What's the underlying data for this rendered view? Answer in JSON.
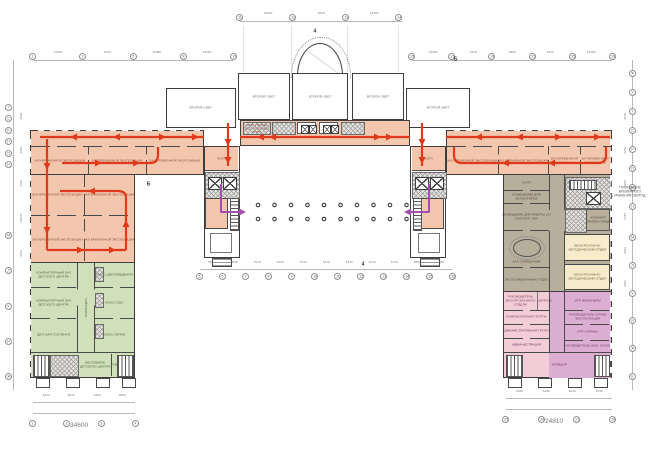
{
  "palette": {
    "exhibition_fill": "#f2c7ae",
    "children_fill": "#cfe0ba",
    "admin_fill": "#b7ae9b",
    "method_fill": "#f6eccb",
    "office_fill": "#f2ccd6",
    "service_fill": "#dcaed2",
    "route_red": "#e03a1a",
    "route_purple": "#a44fb0",
    "wall": "#3e3e3e"
  },
  "rooms": {
    "hall_temp": "ЗАЛ ВРЕМЕННОЙ ЭКСПОЗИЦИИ",
    "second_light": "ВТОРОЙ СВЕТ",
    "hall": "ХОЛЛ",
    "gather": "СБОР У ВХОДА ЭКСКУРСИОННЫХ ГРУПП",
    "computer_class": "КОМПЬЮТЕРНЫЙ ЗАЛ ДЕТСКОГО ЦЕНТРА",
    "kids_lounge": "ДЕТСКАЯ ГОСТИНАЯ",
    "recreation": "РЕКРЕАЦИЯ",
    "class_color": "КЛАСС ЦВЕТОВЕДЕНИЯ",
    "class_izo": "КЛАСС ИЗО",
    "class_lepki": "КЛАСС ЛЕПКИ",
    "kids_vestibule": "ВЕСТИБЮЛЬ ДЕТСКОГО ЦЕНТРА",
    "tambour": "ТАМБУР",
    "volunteers": "ПОМЕЩЕНИЕ ДЛЯ ВОЛОНТЕРОВ",
    "work_attendants": "ПОМЕЩЕНИЕ ДЛЯ РАБОТЫ СО СМОТРИТ. ЗАЛ",
    "meeting": "ЗАЛ СОВЕЩАНИЙ",
    "expo_dept": "ЭКСПОЗИЦИОННЫЙ ОТДЕЛ",
    "eat_room": "КОМНАТА ПРИЕМА ПИЩИ",
    "method_dept": "ЭКСКУРСИОННО-МЕТОДИЧЕСКИЙ ОТДЕЛ",
    "head_excursion": "РУКОВОДИТЕЛЬ ЭКСКУРСИОННОГО ОТДЕЛА",
    "secretary": "СЕКРЕТАРЬ",
    "computer_group": "КОМПЬЮТЕРНАЯ ГРУППА",
    "admin_group": "АДМИНИСТРАТИВНАЯ ГРУППА",
    "administration": "АДМИНИСТРАЦИЯ",
    "itr_eng": "ИТР ИНЖЕНЕРЫ",
    "head_exploitation": "РУКОВОДИТЕЛЬ СЛУЖБ ЭКСПЛУАТАЦИИ",
    "itr_security": "ИТР ОХРАНЫ",
    "head_eng": "РУКОВОДИТЕЛЬ ИНЖ. СЛУЖБ",
    "corridor": "КОРИДОР"
  },
  "annotations": {
    "right_note": "ПОМЕЩЕНИЕ ВРЕМЕННОГО ХРАНЕНИЯ ОБОРУД.",
    "section_top": "4",
    "section_bottom": "4",
    "section_left": "Б",
    "section_right": "Б"
  },
  "grids": {
    "top_center": {
      "bubbles": [
        "11",
        "12",
        "13",
        "14"
      ],
      "dims": [
        "14300",
        "6910",
        "14300"
      ]
    },
    "top_left": {
      "bubbles": [
        "1",
        "3",
        "5",
        "8",
        "10"
      ],
      "dims": [
        "14300",
        "9720",
        "11980",
        "14060"
      ]
    },
    "top_right": {
      "bubbles": [
        "15",
        "17",
        "19",
        "22",
        "25",
        "28"
      ],
      "dims": [
        "14060",
        "9720",
        "6980",
        "9720",
        "14300"
      ]
    },
    "bottom_center": {
      "bubbles": [
        "5",
        "6",
        "7",
        "8",
        "9",
        "10",
        "11",
        "12",
        "13",
        "14",
        "15",
        "16"
      ],
      "dims": [
        "7980",
        "4830",
        "5710",
        "5710",
        "5710",
        "5710",
        "5710",
        "5710",
        "5710",
        "4830",
        "7980"
      ]
    },
    "bottom_left": {
      "bubbles": [
        "1",
        "2",
        "3",
        "4"
      ],
      "dims": [
        "6210",
        "8470",
        "5400",
        "9090"
      ],
      "total": "34600"
    },
    "bottom_right": {
      "bubbles": [
        "25",
        "26",
        "27",
        "28"
      ],
      "dims": [
        "4180",
        "6280",
        "5010",
        "5130"
      ],
      "total": "24810"
    },
    "left_upper": {
      "letters": [
        "Т",
        "С",
        "Р",
        "П",
        "О",
        "Н"
      ]
    },
    "left_lower": {
      "letters": [
        "М",
        "Л",
        "К",
        "И",
        "Ж"
      ]
    },
    "right_upper": {
      "letters": [
        "Ф",
        "У",
        "Т",
        "С",
        "Р",
        "П",
        "О",
        "Н"
      ]
    },
    "right_lower": {
      "letters": [
        "М",
        "Л",
        "К",
        "И",
        "Ж",
        "Е"
      ]
    },
    "left_dims": [
      "2840",
      "4150",
      "7560",
      "10980",
      "7560"
    ],
    "right_dims": [
      "2840",
      "5300",
      "3120",
      "4150",
      "7980",
      "7180"
    ]
  }
}
